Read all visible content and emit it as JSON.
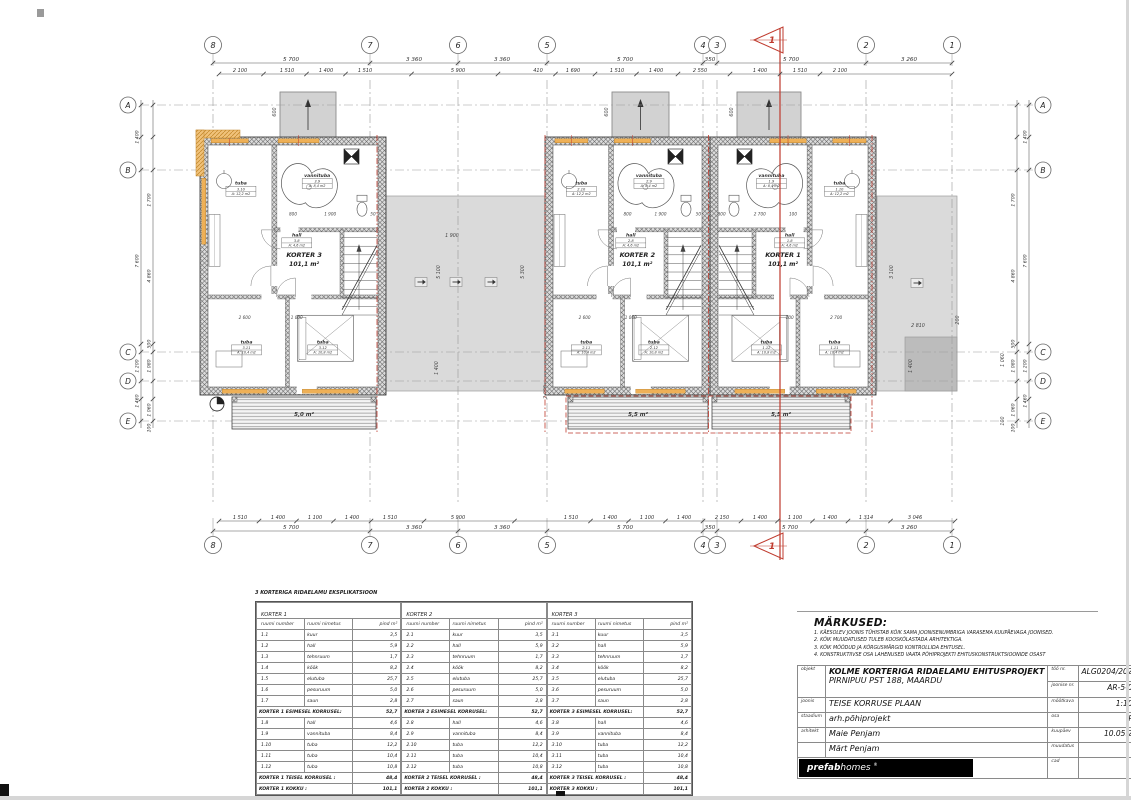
{
  "plan": {
    "unit_y": 137,
    "unit_h": 258,
    "grid": {
      "cols": [
        {
          "label": "8",
          "x": 213
        },
        {
          "label": "7",
          "x": 370
        },
        {
          "label": "6",
          "x": 458
        },
        {
          "label": "5",
          "x": 547
        },
        {
          "label": "4",
          "x": 703
        },
        {
          "label": "3",
          "x": 717
        },
        {
          "label": "2",
          "x": 866
        },
        {
          "label": "1",
          "x": 952
        }
      ],
      "rows": [
        {
          "label": "A",
          "y": 105
        },
        {
          "label": "B",
          "y": 170
        },
        {
          "label": "C",
          "y": 352
        },
        {
          "label": "D",
          "y": 381
        },
        {
          "label": "E",
          "y": 421
        }
      ],
      "bubble_top_y": 45,
      "bubble_bottom_y": 545,
      "row_x_left": 128,
      "row_x_right": 1043
    },
    "dims": {
      "top_primary": {
        "y": 63,
        "x1": 213,
        "x2": 952,
        "items": [
          {
            "t": "5 700",
            "x": 291
          },
          {
            "t": "3 360",
            "x": 414
          },
          {
            "t": "3 360",
            "x": 502
          },
          {
            "t": "5 700",
            "x": 625
          },
          {
            "t": "350",
            "x": 710
          },
          {
            "t": "5 700",
            "x": 791
          },
          {
            "t": "3 260",
            "x": 909
          }
        ]
      },
      "top_detail": {
        "y": 74,
        "x1": 219,
        "x2": 952,
        "items": [
          {
            "t": "2 100",
            "x": 240
          },
          {
            "t": "1 510",
            "x": 287
          },
          {
            "t": "1 400",
            "x": 326
          },
          {
            "t": "1 510",
            "x": 365
          },
          {
            "t": "5 900",
            "x": 458
          },
          {
            "t": "410",
            "x": 538
          },
          {
            "t": "1 690",
            "x": 573
          },
          {
            "t": "1 510",
            "x": 617
          },
          {
            "t": "1 400",
            "x": 656
          },
          {
            "t": "2 550",
            "x": 700
          },
          {
            "t": "1 400",
            "x": 760
          },
          {
            "t": "1 510",
            "x": 800
          },
          {
            "t": "2 100",
            "x": 840
          }
        ]
      },
      "bottom_detail": {
        "y": 521,
        "x1": 219,
        "x2": 955,
        "items": [
          {
            "t": "1 510",
            "x": 240
          },
          {
            "t": "1 400",
            "x": 278
          },
          {
            "t": "1 100",
            "x": 315
          },
          {
            "t": "1 400",
            "x": 352
          },
          {
            "t": "1 510",
            "x": 390
          },
          {
            "t": "5 900",
            "x": 458
          },
          {
            "t": "1 510",
            "x": 571
          },
          {
            "t": "1 400",
            "x": 610
          },
          {
            "t": "1 100",
            "x": 647
          },
          {
            "t": "1 400",
            "x": 684
          },
          {
            "t": "2 150",
            "x": 722
          },
          {
            "t": "1 400",
            "x": 760
          },
          {
            "t": "1 100",
            "x": 795
          },
          {
            "t": "1 400",
            "x": 830
          },
          {
            "t": "1 314",
            "x": 866
          },
          {
            "t": "3 046",
            "x": 915
          }
        ]
      },
      "bottom_primary": {
        "y": 531,
        "x1": 213,
        "x2": 952,
        "items": [
          {
            "t": "5 700",
            "x": 291
          },
          {
            "t": "3 360",
            "x": 414
          },
          {
            "t": "3 360",
            "x": 502
          },
          {
            "t": "5 700",
            "x": 625
          },
          {
            "t": "350",
            "x": 710
          },
          {
            "t": "5 700",
            "x": 790
          },
          {
            "t": "3 260",
            "x": 909
          }
        ]
      },
      "left_outer": {
        "x": 141,
        "items": [
          {
            "t": "1 400",
            "y": 137
          },
          {
            "t": "7 600",
            "y": 261
          },
          {
            "t": "1 200",
            "y": 366
          },
          {
            "t": "1 460",
            "y": 401
          }
        ]
      },
      "left_inner": {
        "x": 153,
        "items": [
          {
            "t": "1 700",
            "y": 200
          },
          {
            "t": "4 860",
            "y": 276
          },
          {
            "t": "500",
            "y": 344
          },
          {
            "t": "1 080",
            "y": 366
          },
          {
            "t": "1 060",
            "y": 410
          },
          {
            "t": "100",
            "y": 428
          }
        ]
      },
      "right_outer": {
        "x": 1029,
        "items": [
          {
            "t": "1 400",
            "y": 137
          },
          {
            "t": "7 600",
            "y": 261
          },
          {
            "t": "1 200",
            "y": 366
          },
          {
            "t": "1 460",
            "y": 401
          }
        ]
      },
      "right_inner": {
        "x": 1017,
        "items": [
          {
            "t": "1 700",
            "y": 200
          },
          {
            "t": "4 860",
            "y": 276
          },
          {
            "t": "500",
            "y": 344
          },
          {
            "t": "1 080",
            "y": 366
          },
          {
            "t": "1 060",
            "y": 410
          },
          {
            "t": "100",
            "y": 428
          }
        ]
      }
    },
    "roofs": [
      {
        "x": 386,
        "y": 196,
        "w": 159,
        "h": 195,
        "dark": false
      },
      {
        "x": 877,
        "y": 196,
        "w": 80,
        "h": 195,
        "dark": false
      },
      {
        "x": 905,
        "y": 337,
        "w": 52,
        "h": 54,
        "dark": true
      }
    ],
    "canopies": [
      {
        "x": 280,
        "w": 56
      },
      {
        "x": 612,
        "w": 57
      },
      {
        "x": 737,
        "w": 64
      }
    ],
    "roof_arrows": [
      {
        "x": 421,
        "y": 282
      },
      {
        "x": 456,
        "y": 282
      },
      {
        "x": 491,
        "y": 282
      },
      {
        "x": 917,
        "y": 283
      }
    ],
    "roof_labels": [
      {
        "t": "1 900",
        "x": 452,
        "y": 237,
        "rot": 0
      },
      {
        "t": "5 300",
        "x": 524,
        "y": 272,
        "rot": -90
      },
      {
        "t": "5 100",
        "x": 440,
        "y": 272,
        "rot": -90
      },
      {
        "t": "1 400",
        "x": 438,
        "y": 368,
        "rot": -90
      },
      {
        "t": "2 000",
        "x": 547,
        "y": 392,
        "rot": -90
      },
      {
        "t": "3 100",
        "x": 893,
        "y": 272,
        "rot": -90
      },
      {
        "t": "2 810",
        "x": 918,
        "y": 327,
        "rot": 0
      },
      {
        "t": "1 400",
        "x": 912,
        "y": 366,
        "rot": -90
      },
      {
        "t": "200",
        "x": 959,
        "y": 320,
        "rot": -90
      },
      {
        "t": "1 060",
        "x": 1004,
        "y": 360,
        "rot": -90
      },
      {
        "t": "100",
        "x": 1004,
        "y": 421,
        "rot": -90
      },
      {
        "t": "600",
        "x": 276,
        "y": 112,
        "rot": -90
      },
      {
        "t": "600",
        "x": 608,
        "y": 112,
        "rot": -90
      },
      {
        "t": "600",
        "x": 733,
        "y": 112,
        "rot": -90
      }
    ],
    "units": [
      {
        "name": "KORTER 3",
        "area": "101,1 m²",
        "x": 200,
        "w": 186,
        "mirror": false,
        "left_window": true,
        "rooms": {
          "bath": {
            "name": "vannituba",
            "num": "3.9",
            "area": "A: 8,4 m2"
          },
          "hall": {
            "name": "hall",
            "num": "3.8",
            "area": "A: 4,6 m2"
          },
          "tuba_top": {
            "name": "tuba",
            "num": "3.10",
            "area": "A: 12,2 m2"
          },
          "tuba_bl": {
            "name": "tuba",
            "num": "3.11",
            "area": "A: 10,4 m2"
          },
          "tuba_br": {
            "name": "tuba",
            "num": "3.12",
            "area": "A: 10,8 m2"
          }
        },
        "dims_mid": [
          "800",
          "1 900",
          "50"
        ],
        "dims_bottom": [
          "2 600",
          "1 000"
        ]
      },
      {
        "name": "KORTER 2",
        "area": "101,1 m²",
        "x": 545,
        "w": 165,
        "mirror": false,
        "left_window": false,
        "rooms": {
          "bath": {
            "name": "vannituba",
            "num": "2.9",
            "area": "A: 8,4 m2"
          },
          "hall": {
            "name": "hall",
            "num": "2.8",
            "area": "A: 4,6 m2"
          },
          "tuba_top": {
            "name": "tuba",
            "num": "2.10",
            "area": "A: 12,2 m2"
          },
          "tuba_bl": {
            "name": "tuba",
            "num": "2.11",
            "area": "A: 10,4 m2"
          },
          "tuba_br": {
            "name": "tuba",
            "num": "2.12",
            "area": "A: 10,8 m2"
          }
        },
        "dims_mid": [
          "800",
          "1 900",
          "50"
        ],
        "dims_bottom": [
          "2 600",
          "1 000"
        ]
      },
      {
        "name": "KORTER 1",
        "area": "101,1 m²",
        "x": 710,
        "w": 166,
        "mirror": true,
        "left_window": false,
        "rooms": {
          "bath": {
            "name": "vannituba",
            "num": "1.9",
            "area": "A: 8,4 m2"
          },
          "hall": {
            "name": "hall",
            "num": "1.8",
            "area": "A: 4,6 m2"
          },
          "tuba_top": {
            "name": "tuba",
            "num": "1.10",
            "area": "A: 12,2 m2"
          },
          "tuba_bl": {
            "name": "tuba",
            "num": "1.11",
            "area": "A: 10,4 m2"
          },
          "tuba_br": {
            "name": "tuba",
            "num": "1.12",
            "area": "A: 10,8 m2"
          }
        },
        "dims_mid": [
          "100",
          "2 700",
          "800"
        ],
        "dims_bottom": [
          "2 700",
          "100"
        ]
      }
    ],
    "balconies": [
      {
        "x": 232,
        "w": 144,
        "label": "5,0 m²"
      },
      {
        "x": 568,
        "w": 140,
        "label": "5,5 m²"
      },
      {
        "x": 712,
        "w": 138,
        "label": "5,5 m²"
      }
    ],
    "section": {
      "x": 780,
      "label": "1",
      "color": "#bf3a2d"
    },
    "firewalls": [
      377,
      545,
      708.5,
      872
    ]
  },
  "explication": {
    "title": "3 KORTERIGA RIDAELAMU EKSPLIKATSIOON",
    "col_headers": [
      "ruumi number",
      "ruumi nimetus",
      "pind m²"
    ],
    "tables": [
      {
        "title": "KORTER 1",
        "floor1_rows": [
          [
            "1.1",
            "kuur",
            "3,5"
          ],
          [
            "1.2",
            "hall",
            "5,9"
          ],
          [
            "1.3",
            "tehnruum",
            "1,7"
          ],
          [
            "1.4",
            "köök",
            "8,2"
          ],
          [
            "1.5",
            "elutuba",
            "25,7"
          ],
          [
            "1.6",
            "pesuruum",
            "5,0"
          ],
          [
            "1.7",
            "saun",
            "2,8"
          ]
        ],
        "floor1_total": [
          "KORTER 1 ESIMESEL KORRUSEL:",
          "52,7"
        ],
        "floor2_rows": [
          [
            "1.8",
            "hall",
            "4,6"
          ],
          [
            "1.9",
            "vannituba",
            "8,4"
          ],
          [
            "1.10",
            "tuba",
            "12,2"
          ],
          [
            "1.11",
            "tuba",
            "10,4"
          ],
          [
            "1.12",
            "tuba",
            "10,8"
          ]
        ],
        "floor2_total": [
          "KORTER 1 TEISEL KORRUSEL :",
          "48,4"
        ],
        "total": [
          "KORTER 1  KOKKU :",
          "101,1"
        ]
      },
      {
        "title": "KORTER 2",
        "floor1_rows": [
          [
            "2.1",
            "kuur",
            "3,5"
          ],
          [
            "2.2",
            "hall",
            "5,9"
          ],
          [
            "2.3",
            "tehnruum",
            "1,7"
          ],
          [
            "2.4",
            "köök",
            "8,2"
          ],
          [
            "2.5",
            "elutuba",
            "25,7"
          ],
          [
            "2.6",
            "pesuruum",
            "5,0"
          ],
          [
            "2.7",
            "saun",
            "2,8"
          ]
        ],
        "floor1_total": [
          "KORTER 2 ESIMESEL KORRUSEL:",
          "52,7"
        ],
        "floor2_rows": [
          [
            "2.8",
            "hall",
            "4,6"
          ],
          [
            "2.9",
            "vannituba",
            "8,4"
          ],
          [
            "2.10",
            "tuba",
            "12,2"
          ],
          [
            "2.11",
            "tuba",
            "10,4"
          ],
          [
            "2.12",
            "tuba",
            "10,8"
          ]
        ],
        "floor2_total": [
          "KORTER 2 TEISEL KORRUSEL :",
          "48,4"
        ],
        "total": [
          "KORTER 2  KOKKU :",
          "101,1"
        ]
      },
      {
        "title": "KORTER 3",
        "floor1_rows": [
          [
            "3.1",
            "kuur",
            "3,5"
          ],
          [
            "3.2",
            "hall",
            "5,9"
          ],
          [
            "3.3",
            "tehnruum",
            "1,7"
          ],
          [
            "3.4",
            "köök",
            "8,2"
          ],
          [
            "3.5",
            "elutuba",
            "25,7"
          ],
          [
            "3.6",
            "pesuruum",
            "5,0"
          ],
          [
            "3.7",
            "saun",
            "2,8"
          ]
        ],
        "floor1_total": [
          "KORTER 3 ESIMESEL KORRUSEL:",
          "52,7"
        ],
        "floor2_rows": [
          [
            "3.8",
            "hall",
            "4,6"
          ],
          [
            "3.9",
            "vannituba",
            "8,4"
          ],
          [
            "3.10",
            "tuba",
            "12,2"
          ],
          [
            "3.11",
            "tuba",
            "10,4"
          ],
          [
            "3.12",
            "tuba",
            "10,8"
          ]
        ],
        "floor2_total": [
          "KORTER 3 TEISEL KORRUSEL :",
          "48,4"
        ],
        "total": [
          "KORTER 3  KOKKU :",
          "101,1"
        ]
      }
    ]
  },
  "notes": {
    "title": "MÄRKUSED:",
    "items": [
      "1. KÄESOLEV JOONIS TÜHISTAB KÕIK SAMA JOONISENUMBRIGA VARASEMA KUUPÄEVAGA JOONISED.",
      "2. KÕIK MUUDATUSED TULEB KOOSKÕLASTADA ARHITEKTIGA.",
      "3. KÕIK MÕÕDUD JA KÕRGUSMÄRGID KONTROLLIDA EHITUSEL.",
      "4. KONSTRUKTIIVSE OSA LAHENUSED VAATA PÕHIPROJEKTI EHITUSKONSTRUKTSIOONIDE OSAST"
    ]
  },
  "titleblock": {
    "objekt_label": "objekt",
    "objekt_line1": "KOLME KORTERIGA RIDAELAMU EHITUSPROJEKT",
    "objekt_line2": "PIRNIPUU PST 188, MAARDU",
    "too_nr_label": "töö nr.",
    "too_nr": "ALG0204/2021",
    "joonise_nr_label": "joonise nr.",
    "joonise_nr": "AR-5-03",
    "joonis_label": "joonis",
    "joonis": "TEISE KORRUSE PLAAN",
    "mootkava_label": "mõõtkava",
    "mootkava": "1:100",
    "staadium_label": "staadium",
    "staadium": "arh.põhiprojekt",
    "osa_label": "osa",
    "osa": "PP",
    "arhitekt_label": "arhitekt",
    "arhitekt1": "Maie Penjam",
    "arhitekt2": "Märt Penjam",
    "kuupaev_label": "kuupäev",
    "kuupaev": "10.05.21",
    "muudatus_label": "muudatus",
    "muudatus": "",
    "cad_label": "cad",
    "cad": "",
    "logo_bold": "prefab",
    "logo_rest": "homes",
    "logo_mark": "®"
  }
}
